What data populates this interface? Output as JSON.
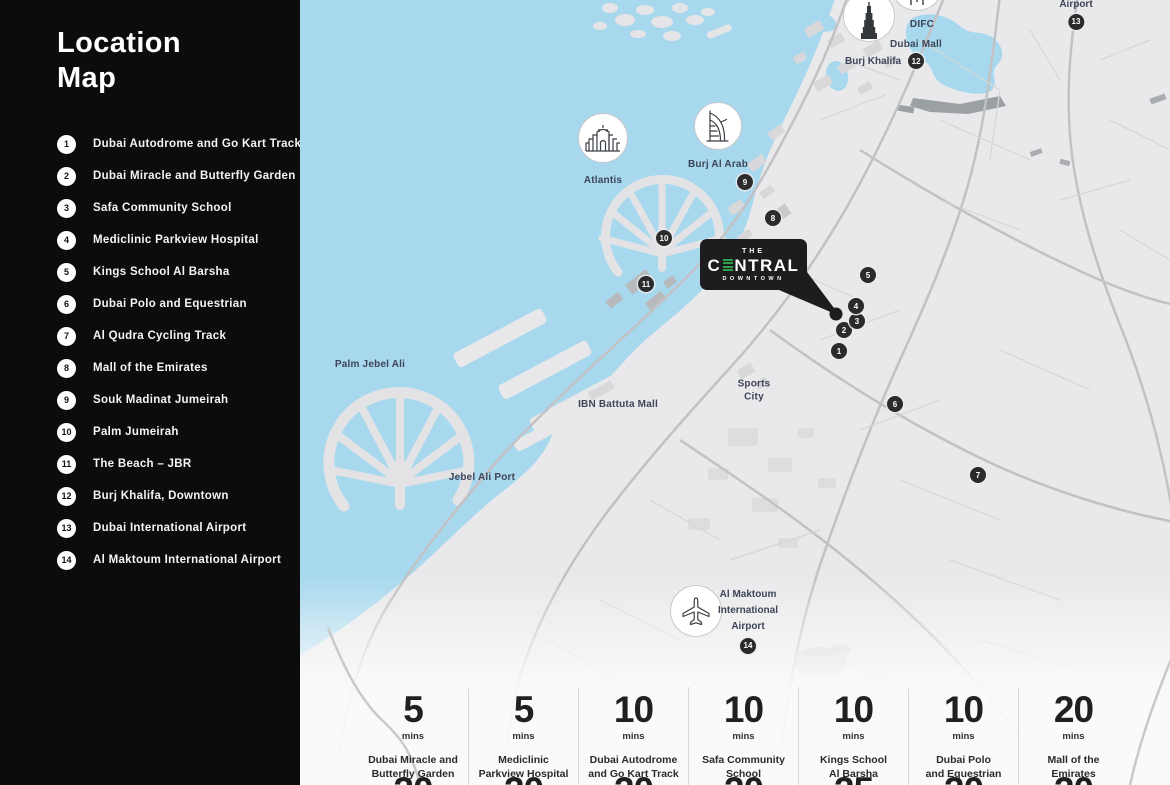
{
  "sidebar": {
    "title": "Location Map",
    "items": [
      {
        "num": "1",
        "label": "Dubai Autodrome and Go Kart Track"
      },
      {
        "num": "2",
        "label": "Dubai Miracle and Butterfly Garden"
      },
      {
        "num": "3",
        "label": "Safa Community School"
      },
      {
        "num": "4",
        "label": "Mediclinic Parkview Hospital"
      },
      {
        "num": "5",
        "label": "Kings School Al Barsha"
      },
      {
        "num": "6",
        "label": "Dubai Polo and Equestrian"
      },
      {
        "num": "7",
        "label": "Al Qudra Cycling Track"
      },
      {
        "num": "8",
        "label": "Mall of the Emirates"
      },
      {
        "num": "9",
        "label": "Souk Madinat Jumeirah"
      },
      {
        "num": "10",
        "label": "Palm Jumeirah"
      },
      {
        "num": "11",
        "label": "The Beach – JBR"
      },
      {
        "num": "12",
        "label": "Burj Khalifa, Downtown"
      },
      {
        "num": "13",
        "label": "Dubai International Airport"
      },
      {
        "num": "14",
        "label": "Al Maktoum International Airport"
      }
    ]
  },
  "map": {
    "markers": [
      "1",
      "2",
      "3",
      "4",
      "5",
      "6",
      "7",
      "8",
      "9",
      "10",
      "11",
      "12",
      "13",
      "14"
    ],
    "labels": {
      "difc": "DIFC",
      "dubai_mall": "Dubai Mall",
      "burj_khalifa": "Burj Khalifa",
      "airport": "Airport",
      "atlantis": "Atlantis",
      "burj_al_arab": "Burj Al Arab",
      "palm_jebel_ali": "Palm Jebel Ali",
      "ibn_battuta_mall": "IBN Battuta Mall",
      "jebel_ali_port": "Jebel Ali Port",
      "sports_city_line1": "Sports",
      "sports_city_line2": "City",
      "al_maktoum_line1": "Al Maktoum",
      "al_maktoum_line2": "International",
      "al_maktoum_line3": "Airport"
    },
    "logo": {
      "top": "THE",
      "brand_pre": "C",
      "brand_post": "NTRAL",
      "sub": "DOWNTOWN"
    }
  },
  "stats": {
    "columns": [
      {
        "value": "5",
        "unit": "mins",
        "line1": "Dubai Miracle and",
        "line2": "Butterfly Garden"
      },
      {
        "value": "5",
        "unit": "mins",
        "line1": "Mediclinic",
        "line2": "Parkview Hospital"
      },
      {
        "value": "10",
        "unit": "mins",
        "line1": "Dubai Autodrome",
        "line2": "and Go Kart Track"
      },
      {
        "value": "10",
        "unit": "mins",
        "line1": "Safa Community",
        "line2": "School"
      },
      {
        "value": "10",
        "unit": "mins",
        "line1": "Kings School",
        "line2": "Al Barsha"
      },
      {
        "value": "10",
        "unit": "mins",
        "line1": "Dubai Polo",
        "line2": "and Equestrian"
      },
      {
        "value": "20",
        "unit": "mins",
        "line1": "Mall of the",
        "line2": "Emirates"
      }
    ],
    "next_row_values": [
      "20",
      "20",
      "20",
      "20",
      "25",
      "20",
      "20"
    ]
  },
  "colors": {
    "sidebar_bg": "#0c0c0c",
    "water": "#a7d8ee",
    "land": "#e9e9eb",
    "marker_bg": "#2b2b2e",
    "logo_bg": "#1d1d1f",
    "logo_green": "#2f9e4a",
    "label_text": "#3d4557"
  }
}
